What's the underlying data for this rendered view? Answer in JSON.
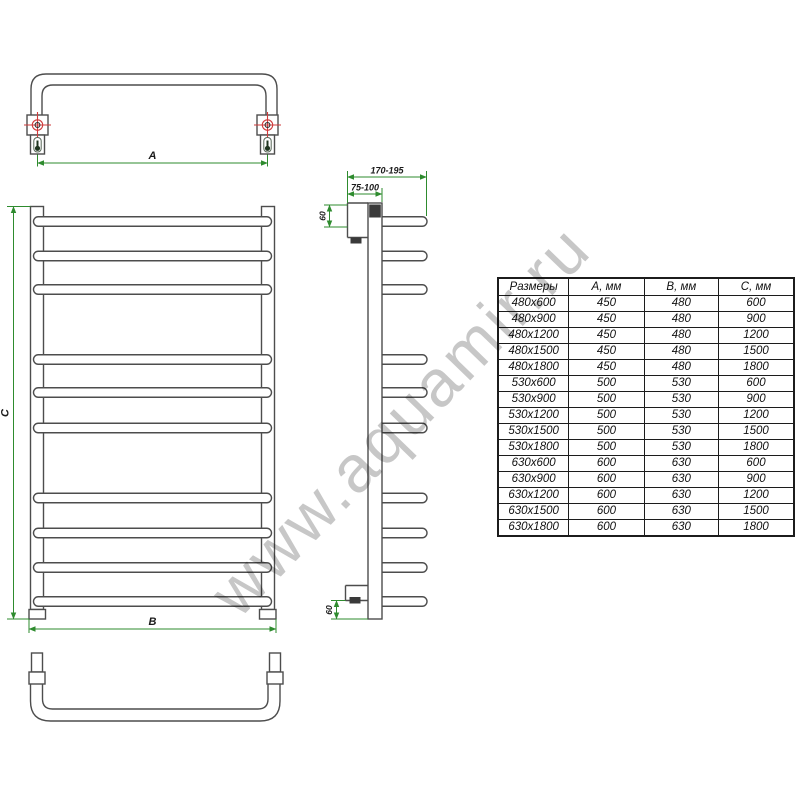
{
  "watermark": {
    "text": "www.aquamir.ru"
  },
  "diagram": {
    "dim_a_label": "A",
    "dim_b_label": "B",
    "dim_c_label": "C",
    "depth_range": "170-195",
    "wall_distance_range": "75-100",
    "top_offset": "60",
    "bottom_offset": "60"
  },
  "table": {
    "headers": {
      "size": "Размеры",
      "a": "А, мм",
      "b": "В, мм",
      "c": "С, мм"
    },
    "rows": [
      {
        "size": "480x600",
        "a": "450",
        "b": "480",
        "c": "600"
      },
      {
        "size": "480x900",
        "a": "450",
        "b": "480",
        "c": "900"
      },
      {
        "size": "480x1200",
        "a": "450",
        "b": "480",
        "c": "1200"
      },
      {
        "size": "480x1500",
        "a": "450",
        "b": "480",
        "c": "1500"
      },
      {
        "size": "480x1800",
        "a": "450",
        "b": "480",
        "c": "1800"
      },
      {
        "size": "530x600",
        "a": "500",
        "b": "530",
        "c": "600"
      },
      {
        "size": "530x900",
        "a": "500",
        "b": "530",
        "c": "900"
      },
      {
        "size": "530x1200",
        "a": "500",
        "b": "530",
        "c": "1200"
      },
      {
        "size": "530x1500",
        "a": "500",
        "b": "530",
        "c": "1500"
      },
      {
        "size": "530x1800",
        "a": "500",
        "b": "530",
        "c": "1800"
      },
      {
        "size": "630x600",
        "a": "600",
        "b": "630",
        "c": "600"
      },
      {
        "size": "630x900",
        "a": "600",
        "b": "630",
        "c": "900"
      },
      {
        "size": "630x1200",
        "a": "600",
        "b": "630",
        "c": "1200"
      },
      {
        "size": "630x1500",
        "a": "600",
        "b": "630",
        "c": "1500"
      },
      {
        "size": "630x1800",
        "a": "600",
        "b": "630",
        "c": "1800"
      }
    ]
  },
  "colors": {
    "line": "#4d4d4d",
    "dimension": "#2e8b2e",
    "center_mark": "#cf3b3b",
    "watermark": "#c7c7c7"
  }
}
